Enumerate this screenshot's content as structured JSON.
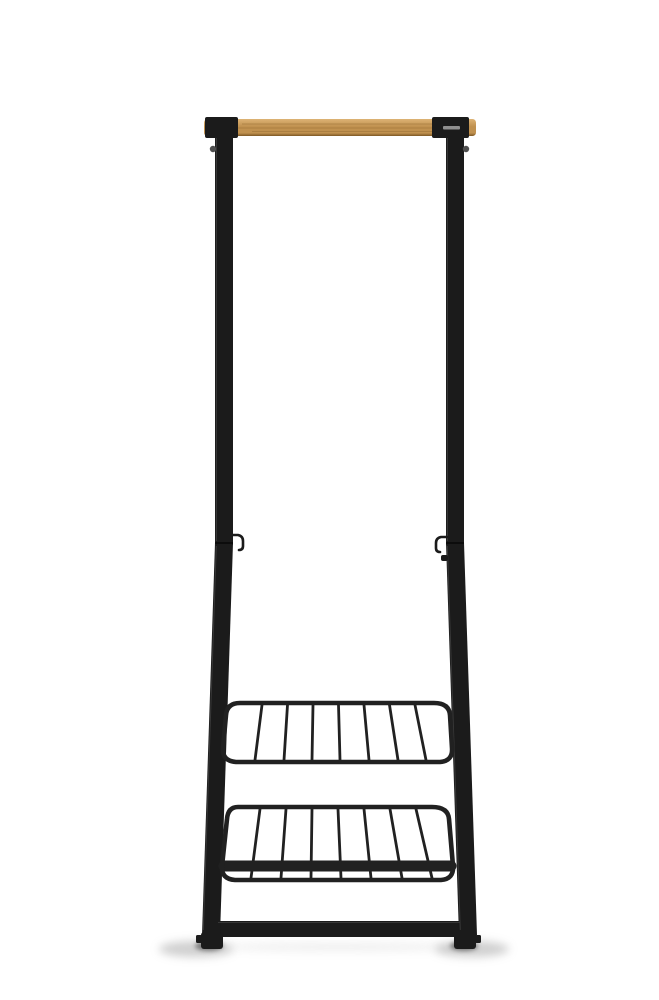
{
  "scene": {
    "kind": "product photo",
    "background": "#ffffff",
    "subject": "Freestanding clothes rack with a bamboo hanging rail, slim black steel frame, two small garment hooks at the mid joint, and two black wire shelves near the base, photographed on a seamless white studio background"
  },
  "rack": {
    "hang_bar": {
      "part": "hanging rail",
      "material": "bamboo wood"
    },
    "clamp_left": {
      "part": "rail clamp, black steel"
    },
    "clamp_right": {
      "part": "rail clamp with small embossed logo plate"
    },
    "post_left": {
      "part": "upright post, black steel tube"
    },
    "post_right": {
      "part": "upright post, black steel tube"
    },
    "hook_left": {
      "part": "garment hook at joint, facing inward"
    },
    "hook_right": {
      "part": "garment hook at joint, facing inward, with lower stub"
    },
    "shelf_upper": {
      "part": "wire shelf",
      "wire_count": 7
    },
    "shelf_lower": {
      "part": "wire shelf with front lip bar",
      "wire_count": 7
    },
    "crossbar": {
      "part": "base crossbar between feet"
    },
    "foot_left": {
      "part": "foot cap with side stud"
    },
    "foot_right": {
      "part": "foot cap with side stud"
    }
  },
  "colors": {
    "background": "#ffffff",
    "metal": "#1b1b1b",
    "metal_edge": "#3d3d3d",
    "wire": "#212121",
    "wood_light": "#ddb375",
    "wood_mid": "#c0914f",
    "wood_dark": "#7d5724",
    "wood_grain": "#9a7136",
    "label_plate": "#8f8f8f",
    "knob": "#4f4f4f",
    "shadow_soft": "#a0a0a0",
    "shadow_core": "#5e5e5e"
  }
}
